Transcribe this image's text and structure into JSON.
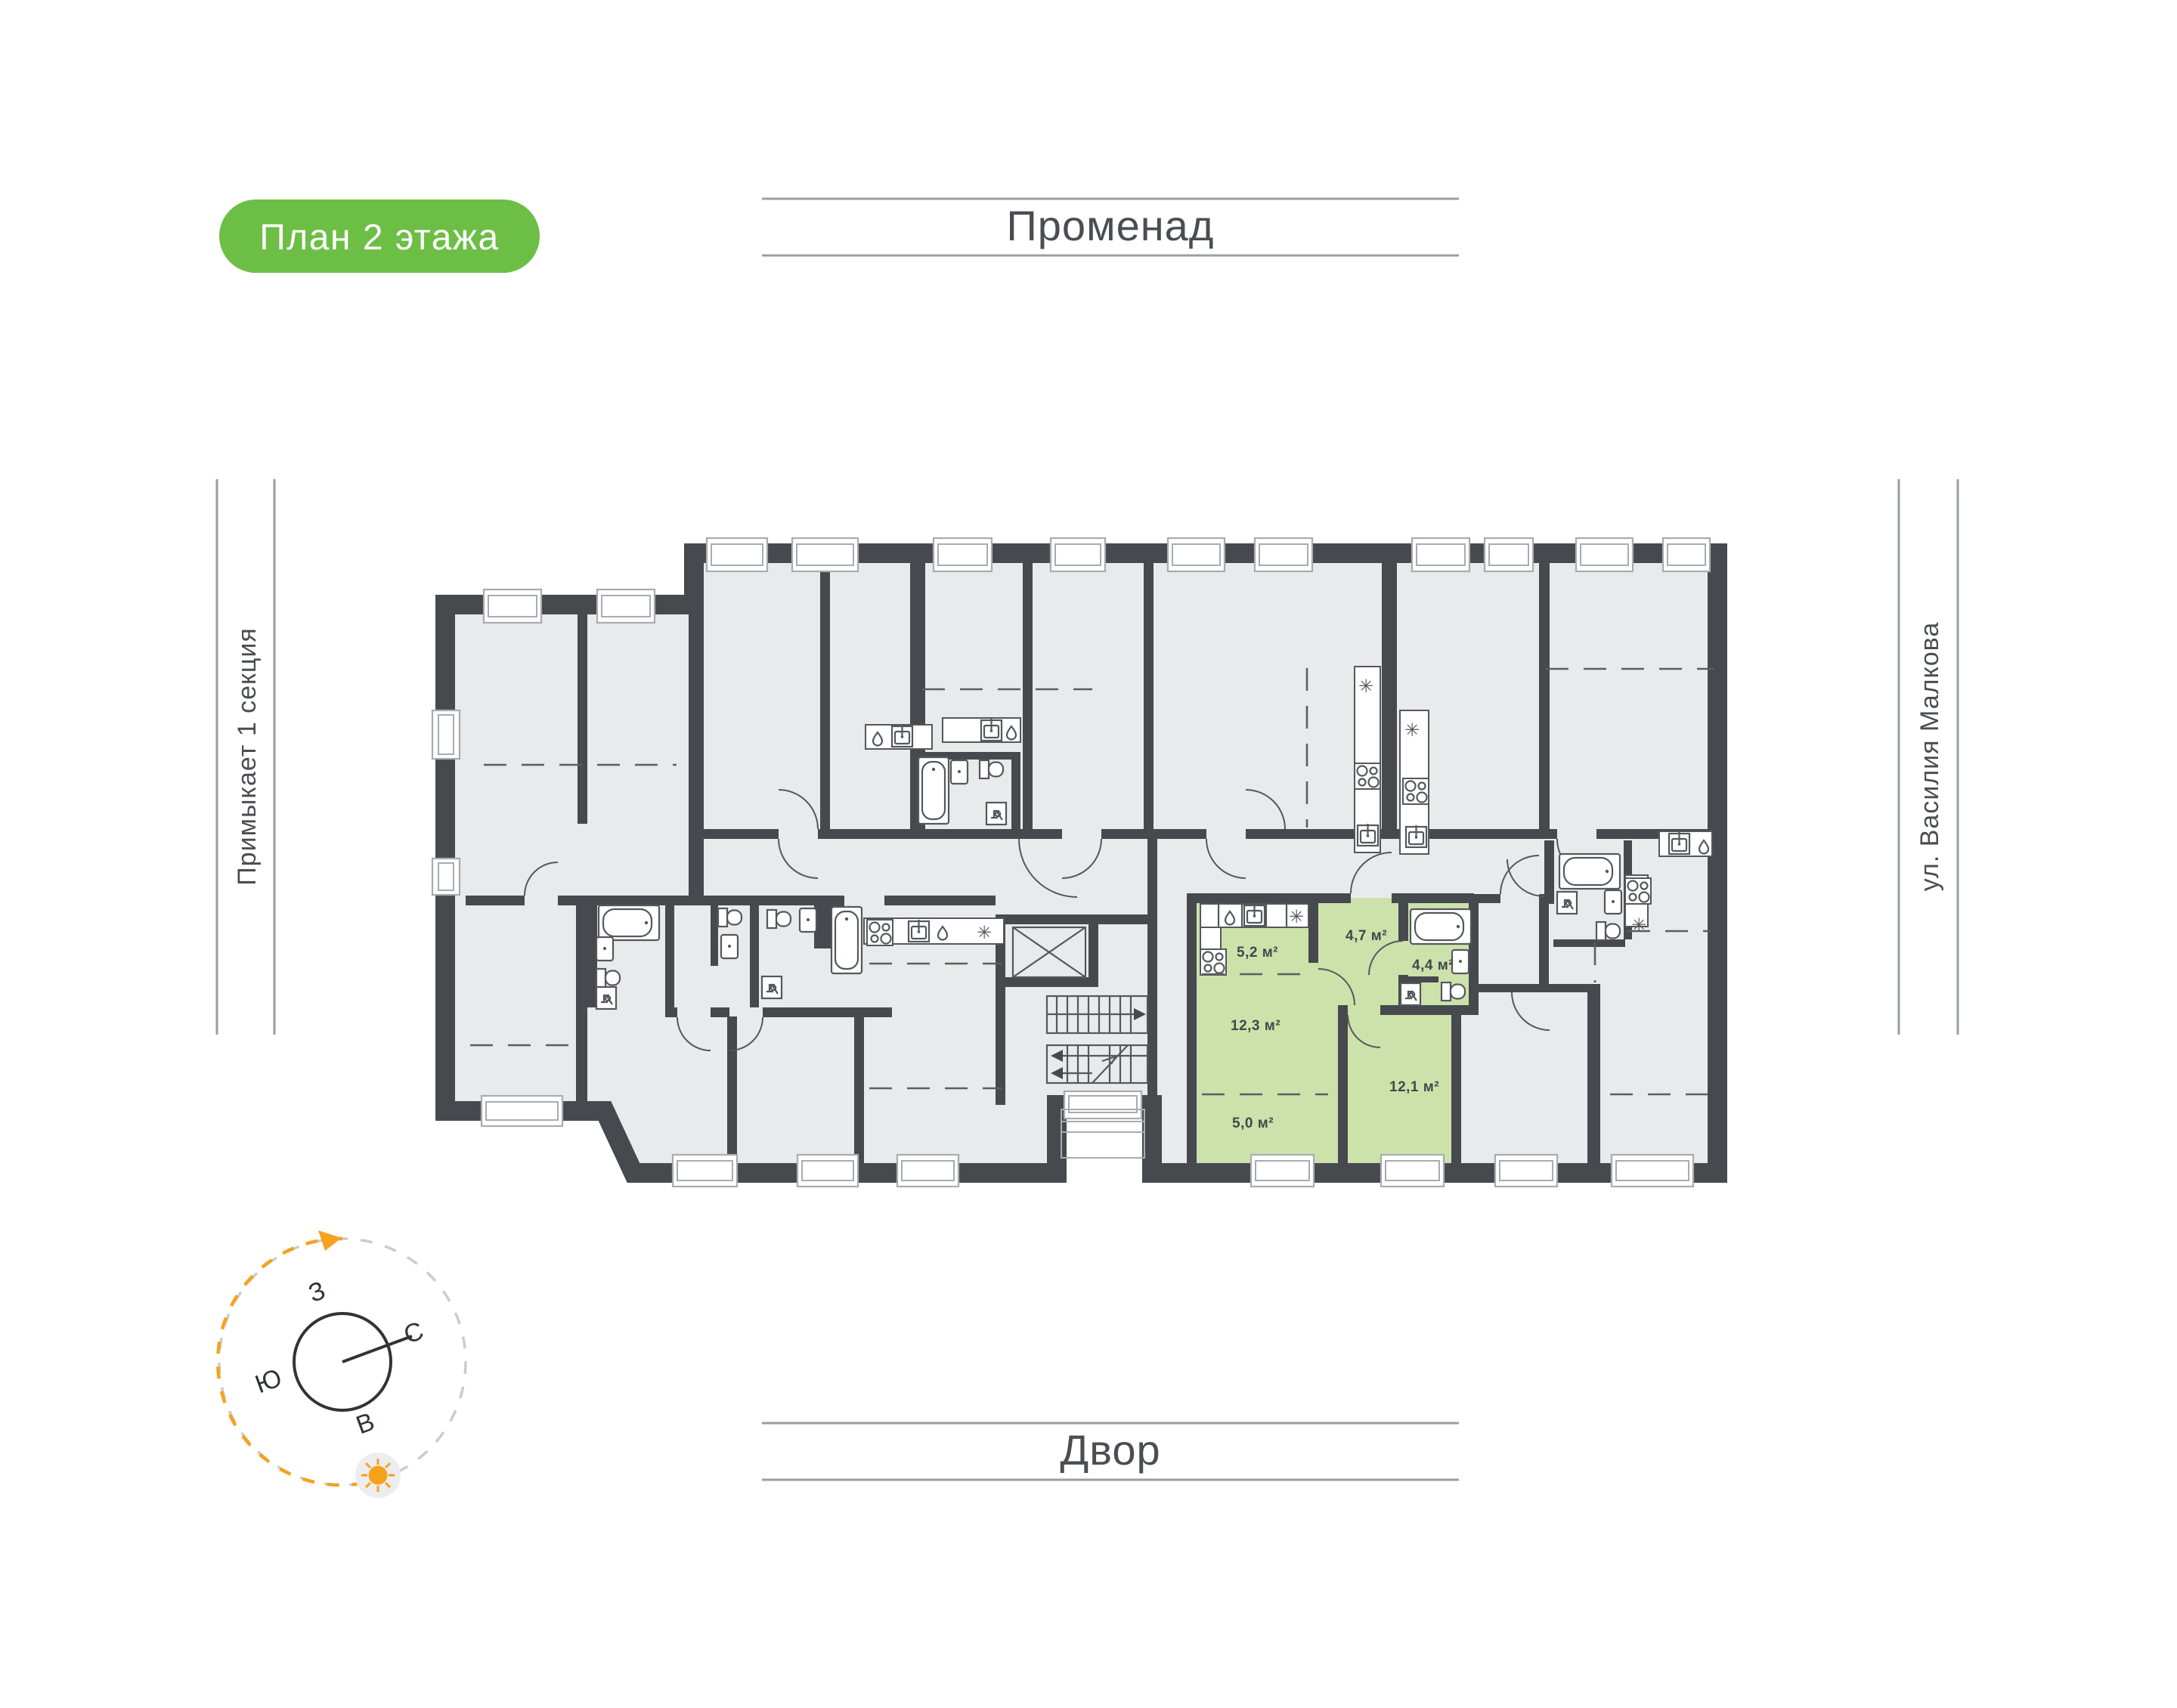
{
  "badge": {
    "label": "План 2 этажа",
    "bg": "#6dbe45",
    "text_color": "#ffffff"
  },
  "surroundings": {
    "top": "Променад",
    "bottom": "Двор",
    "left": "Примыкает 1 секция",
    "right": "ул. Василия Малкова"
  },
  "compass": {
    "west": "З",
    "north": "С",
    "south": "Ю",
    "east": "В",
    "accent": "#f6a21e"
  },
  "plan": {
    "wall_color": "#46494d",
    "floor_color": "#e9eaeb",
    "highlight_color": "#cde2ab",
    "icons": {
      "snowflake": "✳"
    },
    "apartment": {
      "rooms": [
        {
          "name": "kitchen",
          "area": "5,2 м²"
        },
        {
          "name": "hallway",
          "area": "4,7 м²"
        },
        {
          "name": "bathroom",
          "area": "4,4 м²"
        },
        {
          "name": "living-room",
          "area": "12,3 м²"
        },
        {
          "name": "alcove",
          "area": "5,0 м²"
        },
        {
          "name": "bedroom",
          "area": "12,1 м²"
        }
      ]
    }
  }
}
